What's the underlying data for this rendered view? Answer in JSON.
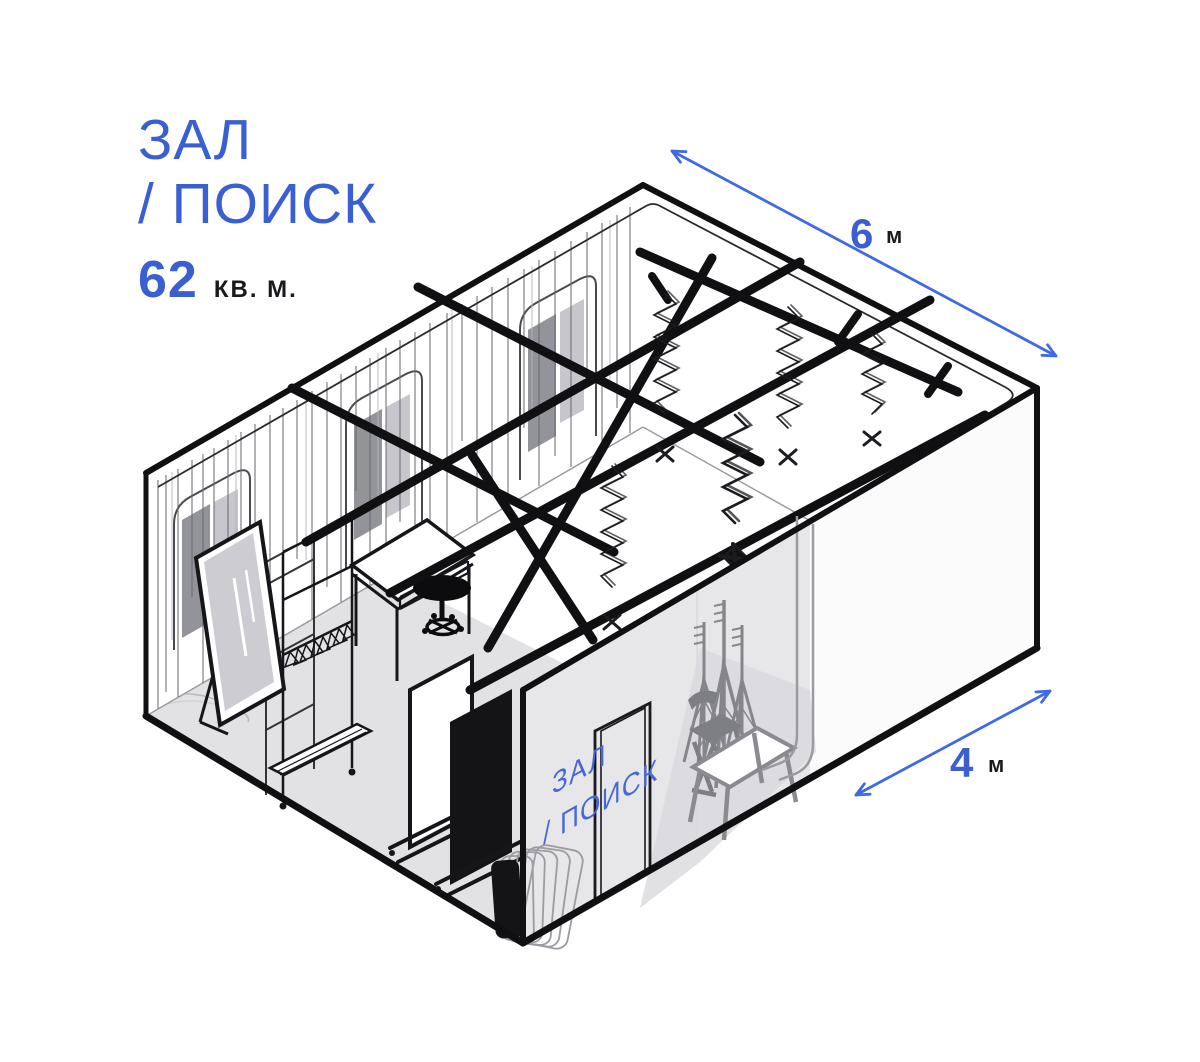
{
  "title": {
    "line1": "ЗАЛ",
    "line2": "/ ПОИСК",
    "area_value": "62",
    "area_unit": "КВ. М."
  },
  "dimensions": {
    "width": {
      "value": "6",
      "unit": "м"
    },
    "depth": {
      "value": "4",
      "unit": "м"
    }
  },
  "door_label": {
    "line1": "ЗАЛ",
    "line2": "/ ПОИСК"
  },
  "palette": {
    "accent_blue": "#3A5FD1",
    "arrow_blue": "#4069E6",
    "ink": "#16161a",
    "wall_gray": "#e7e7ea",
    "floor_gray": "#e2e2e5",
    "silhouette_gray": "#85858b",
    "glass_gray": "#ccccd2"
  },
  "room_objects": [
    "curtain-wall-with-arched-windows",
    "ceiling-rail-system",
    "pantographs",
    "standing-mirror",
    "clothes-rack-with-hangers",
    "open-shelf-frame",
    "desk",
    "stool",
    "white-reflector-panel",
    "black-reflector-panel",
    "frame-stack",
    "door",
    "backdrop-roll",
    "light-stands",
    "folding-chair",
    "table"
  ]
}
